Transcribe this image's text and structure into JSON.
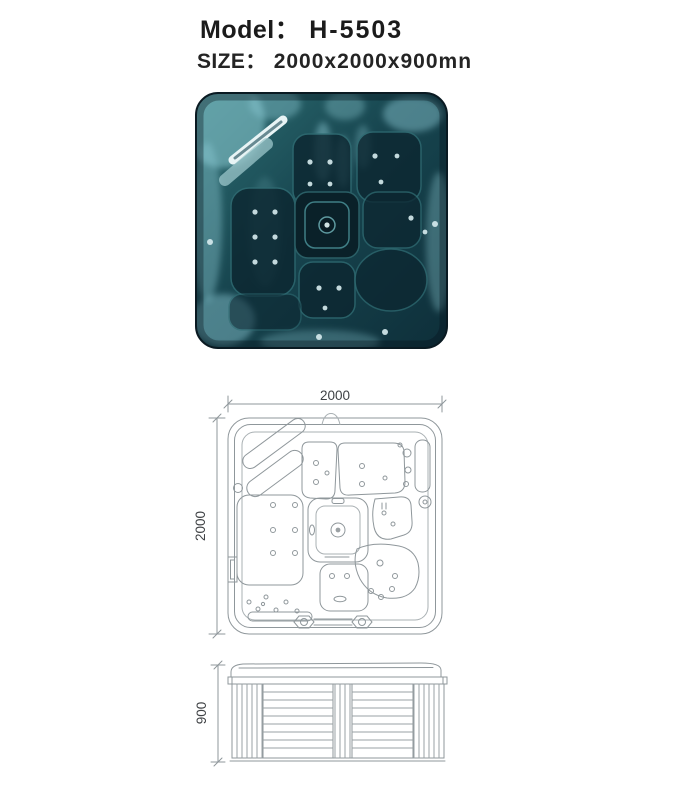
{
  "header": {
    "model_label": "Model：",
    "model_value": "H-5503",
    "size_label": "SIZE：",
    "size_value": "2000x2000x900mn"
  },
  "photo": {
    "alt": "top view photo of square spa tub with dark teal acrylic shell",
    "base_color": "#1c5560",
    "dark_color": "#0c2630",
    "highlight_color": "#8ecdd6"
  },
  "plan_view": {
    "width_dim": "2000",
    "depth_dim": "2000"
  },
  "side_view": {
    "height_dim": "900"
  }
}
